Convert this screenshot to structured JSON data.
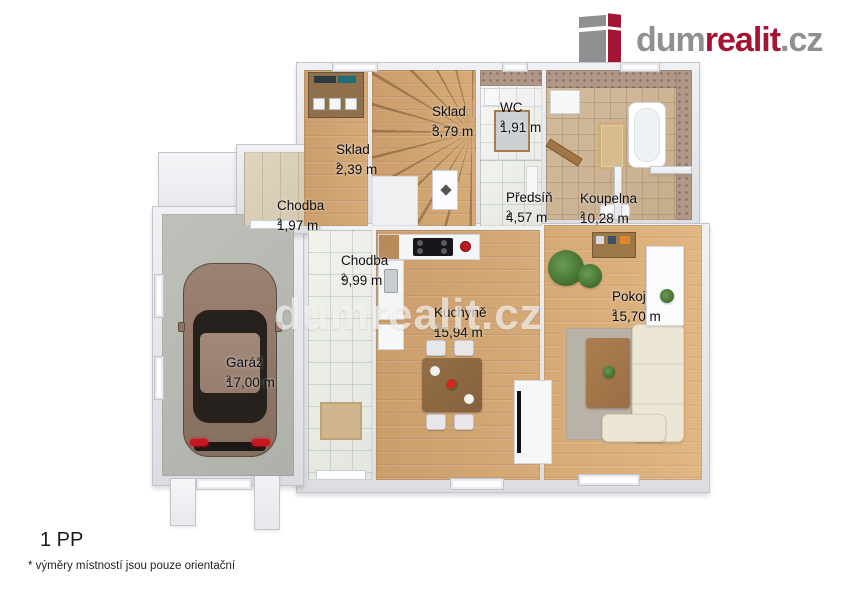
{
  "brand": {
    "dum": "dum",
    "realit": "realit",
    "cz": ".cz",
    "color_red": "#a31532",
    "color_gray": "#8f9091"
  },
  "watermark": {
    "text": "dumrealit.cz"
  },
  "rooms": [
    {
      "id": "sklad-small",
      "name": "Sklad",
      "area": "2,39 m",
      "sup": "2"
    },
    {
      "id": "sklad-stairs",
      "name": "Sklad",
      "area": "3,79 m",
      "sup": "2"
    },
    {
      "id": "wc",
      "name": "WC",
      "area": "1,91 m",
      "sup": "2"
    },
    {
      "id": "chodba-small",
      "name": "Chodba",
      "area": "1,97 m",
      "sup": "2"
    },
    {
      "id": "predsin",
      "name": "Předsíň",
      "area": "4,57 m",
      "sup": "2"
    },
    {
      "id": "koupelna",
      "name": "Koupelna",
      "area": "10,28 m",
      "sup": "2"
    },
    {
      "id": "chodba-main",
      "name": "Chodba",
      "area": "9,99 m",
      "sup": "2"
    },
    {
      "id": "kuchyne",
      "name": "Kuchyně",
      "area": "15,94 m",
      "sup": "2"
    },
    {
      "id": "pokoj",
      "name": "Pokoj",
      "area": "15,70 m",
      "sup": "2"
    },
    {
      "id": "garaz",
      "name": "Garáž",
      "area": "17,00 m",
      "sup": "2"
    }
  ],
  "footer": {
    "level": "1 PP",
    "disclaimer": "* výměry místností jsou pouze orientační"
  }
}
